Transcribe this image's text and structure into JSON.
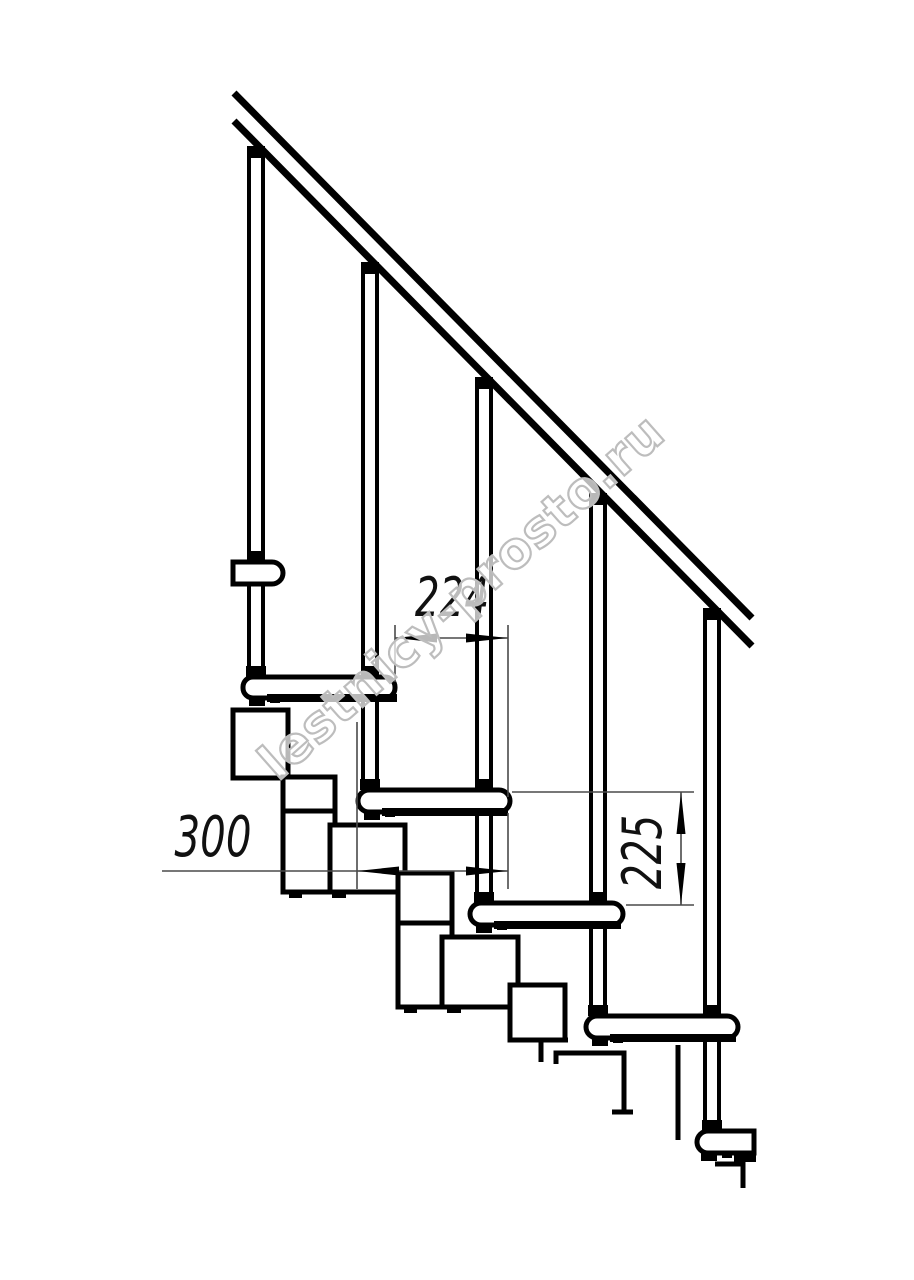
{
  "diagram": {
    "type": "technical-drawing",
    "subject": "modular staircase side elevation with handrail and balusters",
    "dimension_labels": {
      "run": "224",
      "depth": "300",
      "rise": "225"
    },
    "watermark": {
      "text": "lestnicy-prosto.ru"
    },
    "colors": {
      "line": "#000000",
      "thin_line": "#4a4a4a",
      "watermark_outline": "#bdbdbd",
      "background": "#ffffff"
    },
    "counts": {
      "balusters": 5,
      "treads": 5,
      "spine_modules": 6
    }
  }
}
